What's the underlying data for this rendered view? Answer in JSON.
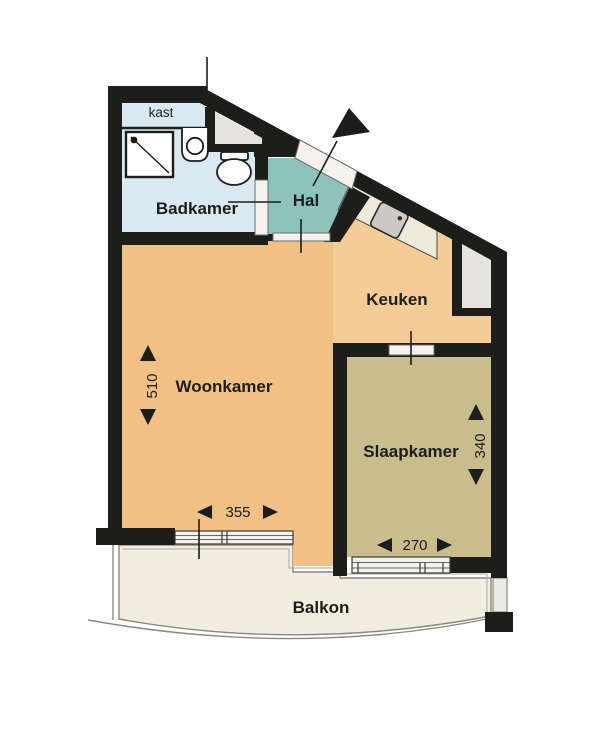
{
  "rooms": {
    "kast": {
      "label": "kast"
    },
    "badkamer": {
      "label": "Badkamer"
    },
    "hal": {
      "label": "Hal"
    },
    "keuken": {
      "label": "Keuken"
    },
    "woonkamer": {
      "label": "Woonkamer",
      "depth_cm": "510",
      "width_cm": "355"
    },
    "slaapkamer": {
      "label": "Slaapkamer",
      "depth_cm": "340",
      "width_cm": "270"
    },
    "balkon": {
      "label": "Balkon"
    }
  },
  "colors": {
    "wall": "#1d1d1b",
    "badkamer": "#d9e9f2",
    "hal": "#8cc3bc",
    "keuken": "#f4cd96",
    "woonkamer": "#f0c183",
    "slaapkamer": "#c9bd8c",
    "balkon": "#f2ede1",
    "counter": "#efe9da",
    "niche": "#e6e3df",
    "window": "#f4f2ee",
    "fixture": "#ffffff",
    "sink_steel": "#cbc9c5",
    "outline": "#8b897f"
  }
}
